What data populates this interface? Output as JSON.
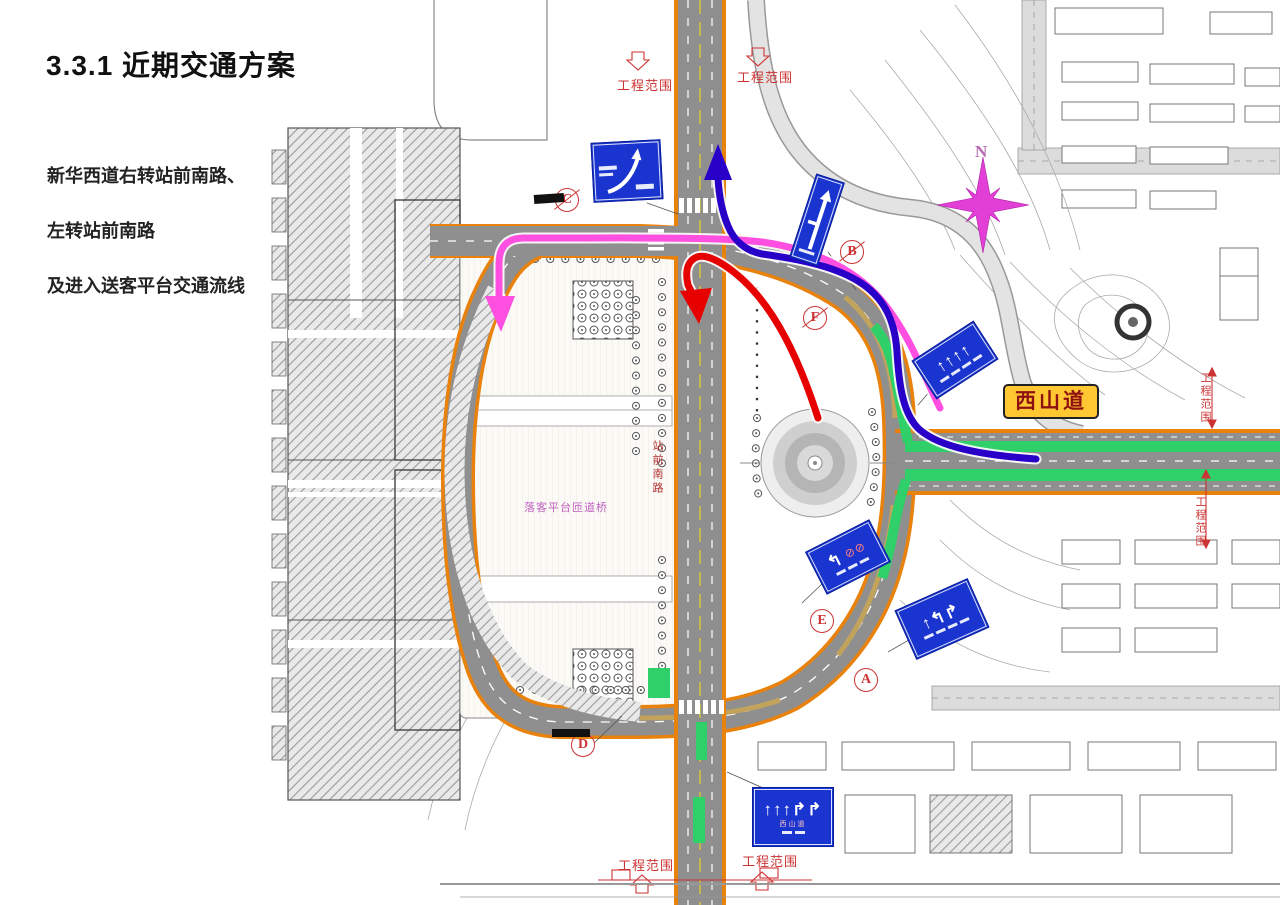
{
  "title": "3.3.1 近期交通方案",
  "description": [
    "新华西道右转站前南路、",
    "左转站前南路",
    "及进入送客平台交通流线"
  ],
  "map": {
    "road_label": "西山道",
    "north_label": "N",
    "ramp_label": "落客平台匝道桥",
    "vertical_road_label": "站前南路",
    "scope_labels": {
      "top_left": "工程范围",
      "top_right": "工程范围",
      "bottom_left": "工程范围",
      "bottom_right": "工程范围",
      "right_upper": "工程范围",
      "right_lower": "工程范围"
    },
    "markers": [
      {
        "letter": "C"
      },
      {
        "letter": "B"
      },
      {
        "letter": "F"
      },
      {
        "letter": "E"
      },
      {
        "letter": "A"
      },
      {
        "letter": "D"
      }
    ],
    "signs": {
      "lane_arrows_quad": "↑↑↑↑",
      "lane_arrows_turns": "↑↰↱",
      "lane_arrows_mixed": "↰",
      "bottom_arrows": "↑↑↑↱↱",
      "bottom_road_text": "西山道",
      "prohibition_icons": "⊘⊘"
    },
    "colors": {
      "flow_pink": "#ff4fe0",
      "flow_red": "#e60000",
      "flow_blue": "#2800c8",
      "lane_green": "#2fd06a",
      "road_edge_orange": "#e8820c",
      "road_surface": "#8f8f8f",
      "label_yellow_bg": "#ffc832",
      "annotation_red": "#cc3333",
      "sign_blue": "#1a35cf",
      "north_magenta": "#e23fd6"
    }
  }
}
